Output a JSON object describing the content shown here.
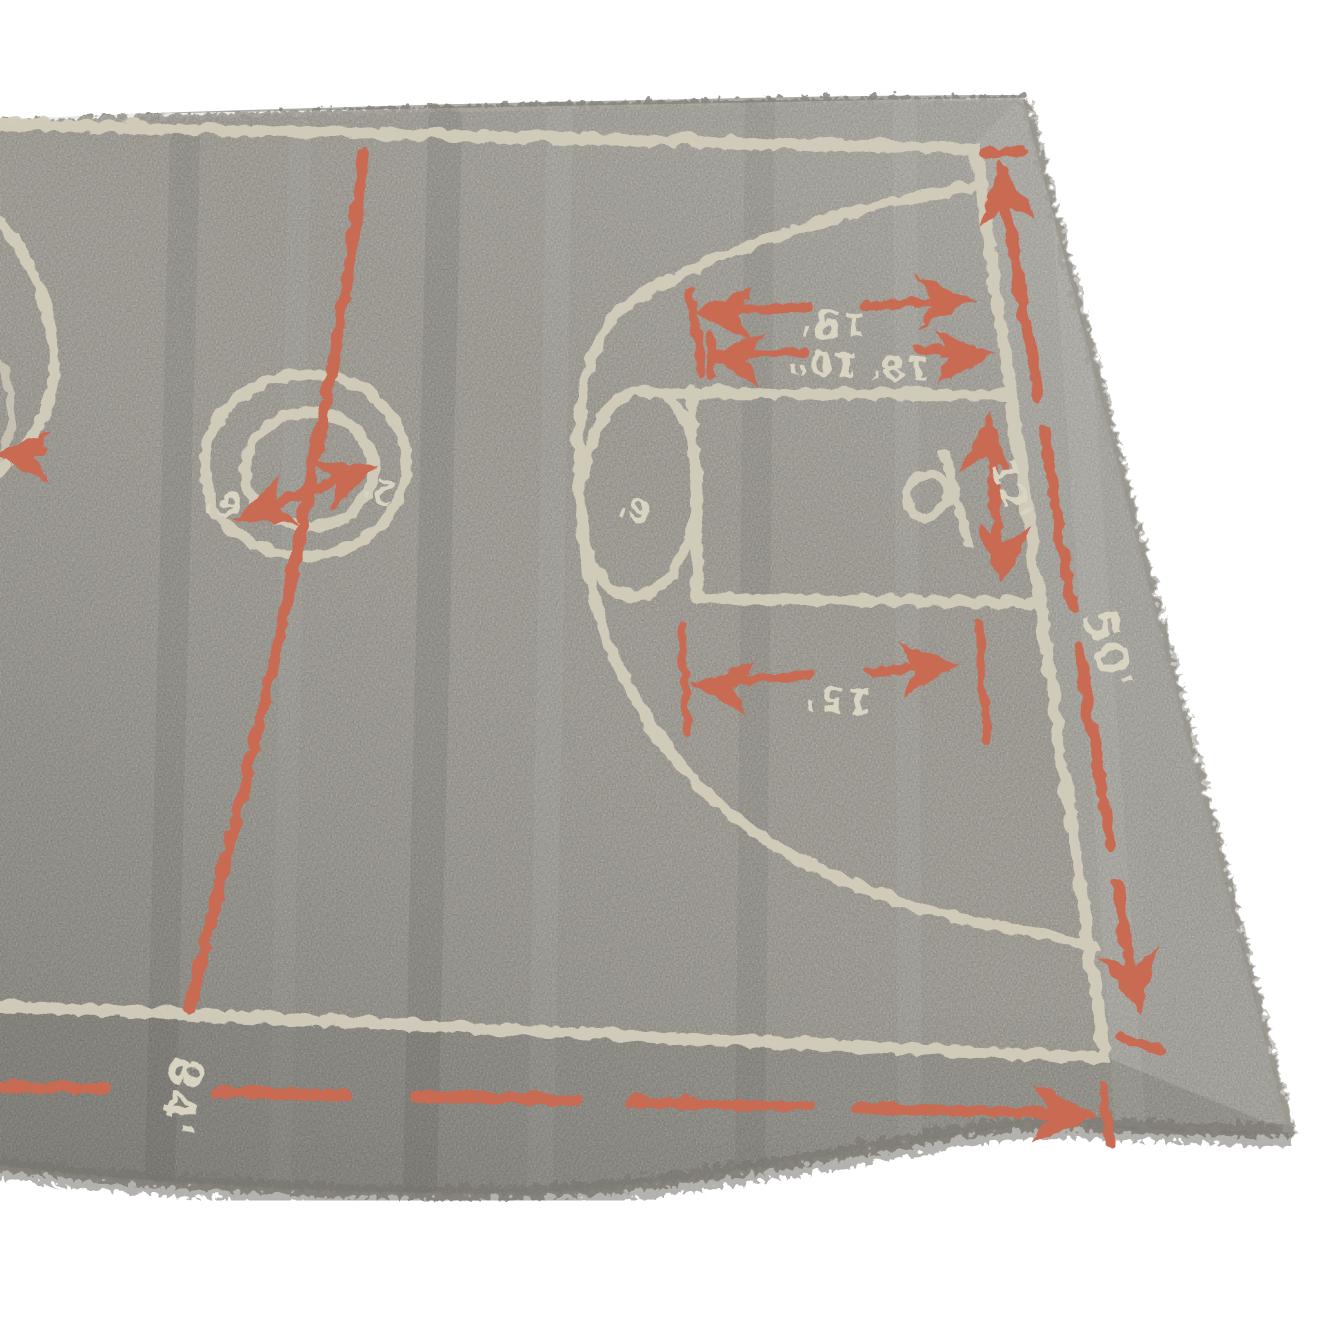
{
  "photo": {
    "background_color": "#ffffff",
    "rug_pile_color": "#8c8a83",
    "court_line_color": "#d6cfbf",
    "accent_red_color": "#c96a52",
    "shadow_color": "#6f6d66"
  },
  "rug": {
    "court_labels": {
      "three_point_distance": "19'",
      "backboard_to_arc": "18' 10\"",
      "lane_width": "12'",
      "free_throw_distance": "15'",
      "court_width": "50'",
      "court_length": "84'",
      "center_circle_outer": "6'",
      "center_circle_inner": "2'",
      "free_throw_circle": "6'"
    },
    "symbols": {
      "arrowhead": "dimension-arrowhead",
      "rim": "rim-and-backboard"
    }
  }
}
